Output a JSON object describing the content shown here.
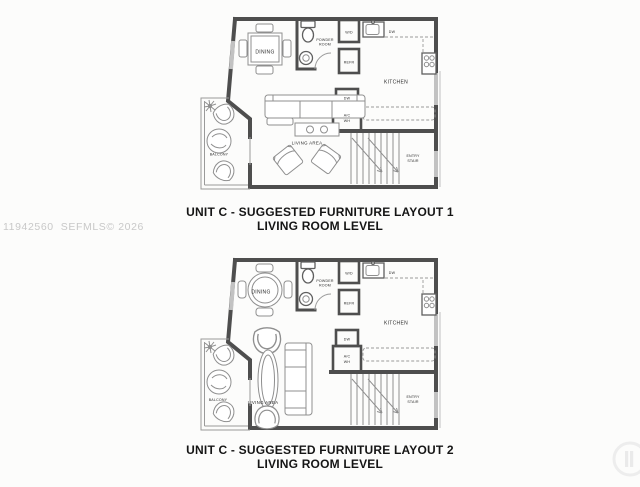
{
  "watermark": {
    "text": "11942560  SEFMLS© 2026"
  },
  "captions": {
    "plan1_line1": "UNIT C - SUGGESTED FURNITURE LAYOUT 1",
    "plan1_line2": "LIVING ROOM LEVEL",
    "plan2_line1": "UNIT C - SUGGESTED FURNITURE LAYOUT 2",
    "plan2_line2": "LIVING ROOM LEVEL"
  },
  "room_labels": {
    "dining": "DINING",
    "powder_line1": "POWDER",
    "powder_line2": "ROOM",
    "washer_dryer": "W/D",
    "refrigerator": "REFR",
    "dishwasher": "DW",
    "kitchen": "KITCHEN",
    "closet_dw": "DW",
    "ac_line1": "A/C",
    "ac_line2": "WH",
    "living_area": "LIVING AREA",
    "balcony": "BALCONY",
    "entry_line1": "ENTRY",
    "entry_line2": "STAIR"
  },
  "colors": {
    "wall": "#4e4e4e",
    "furniture_line": "#8f8f8f",
    "window": "#c2c2c2",
    "caption_text": "#151515",
    "watermark_text": "#c8c8c8",
    "background": "#fcfcfb"
  }
}
